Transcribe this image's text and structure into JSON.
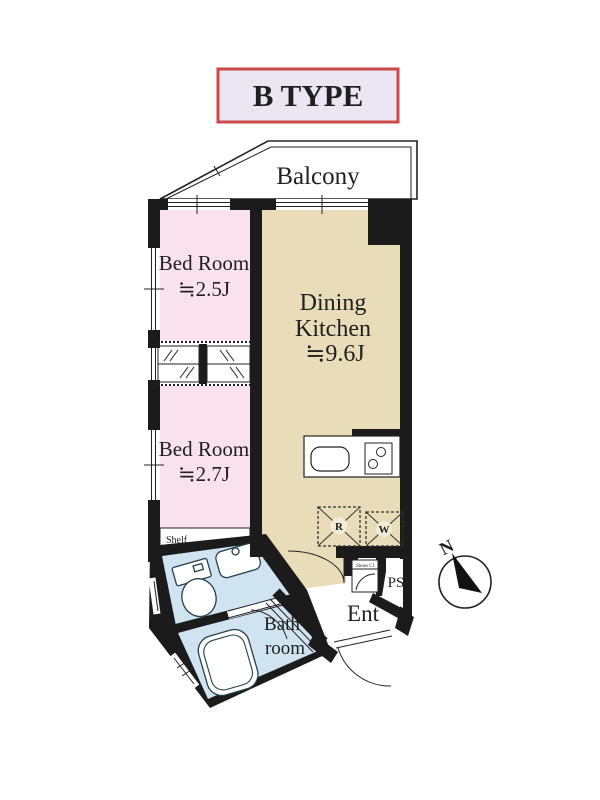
{
  "title": "B TYPE",
  "colors": {
    "bedroom": "#f9e2ee",
    "dining": "#e9dcb8",
    "wet": "#cfe4f0",
    "wall": "#1b1b1b",
    "title_bg": "#eae7f3",
    "title_border": "#cc4949"
  },
  "rooms": {
    "balcony": {
      "label": "Balcony"
    },
    "bedroom1": {
      "label": "Bed Room",
      "size": "≒2.5J"
    },
    "dining": {
      "line1": "Dining",
      "line2": "Kitchen",
      "size": "≒9.6J"
    },
    "bedroom2": {
      "label": "Bed Room",
      "size": "≒2.7J"
    },
    "bath": {
      "line1": "Bath",
      "line2": "room"
    },
    "entrance": {
      "label": "Ent"
    },
    "ps": {
      "label": "PS"
    },
    "shelf": {
      "label": "Shelf"
    },
    "shoes": {
      "label": "Shoes Cl"
    }
  },
  "appliances": {
    "refrigerator": "R",
    "washer": "W"
  },
  "compass": {
    "north": "N"
  }
}
